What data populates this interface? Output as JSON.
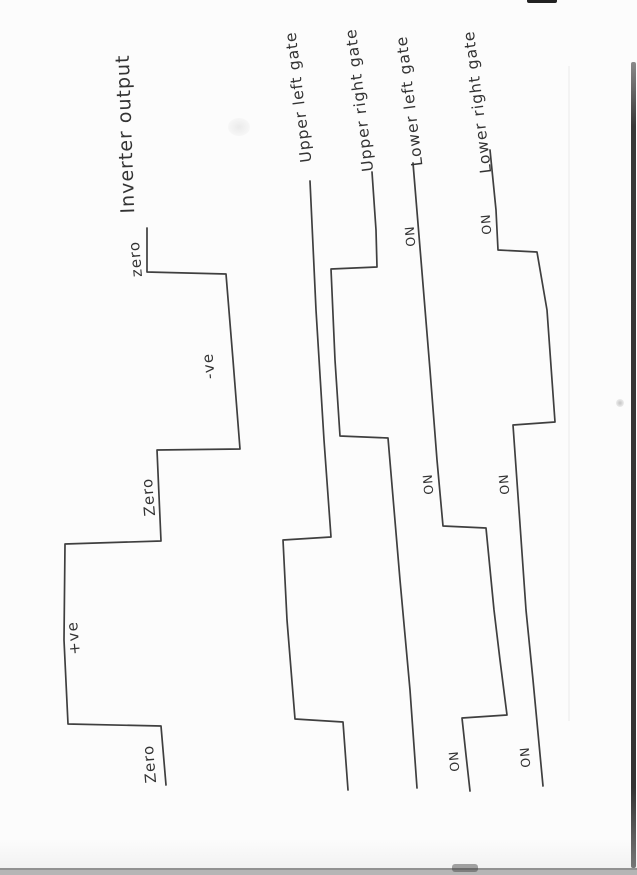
{
  "page": {
    "kind": "scanned hand-drawn waveform diagram, rotated 90° (text reads bottom-to-top)",
    "paper_color": "#fcfcfc",
    "ink_color": "#3f3f3f",
    "edge_strip_color": "#b5b5b5",
    "right_shadow_color": "#3a3a3a"
  },
  "diagram": {
    "signals": [
      {
        "id": "inverter-output",
        "name_label": {
          "text": "Inverter output",
          "x": 126,
          "y": 134,
          "size": 19,
          "angle": -92,
          "title": true
        },
        "points": [
          [
            147,
            228
          ],
          [
            147,
            272
          ],
          [
            226,
            274
          ],
          [
            233,
            360
          ],
          [
            240,
            449
          ],
          [
            157,
            450
          ],
          [
            161,
            541
          ],
          [
            65,
            544
          ],
          [
            64,
            640
          ],
          [
            68,
            724
          ],
          [
            161,
            726
          ],
          [
            166,
            785
          ]
        ],
        "value_labels": [
          {
            "text": "zero",
            "x": 136,
            "y": 259,
            "size": 15,
            "angle": -95
          },
          {
            "text": "-ve",
            "x": 209,
            "y": 366,
            "size": 15,
            "angle": -95
          },
          {
            "text": "Zero",
            "x": 149,
            "y": 497,
            "size": 15,
            "angle": -95
          },
          {
            "text": "+ve",
            "x": 74,
            "y": 638,
            "size": 15,
            "angle": -95
          },
          {
            "text": "Zero",
            "x": 150,
            "y": 764,
            "size": 15,
            "angle": -95
          }
        ]
      },
      {
        "id": "upper-left-gate",
        "name_label": {
          "text": "Upper left gate",
          "x": 299,
          "y": 97,
          "size": 15.5,
          "angle": -97
        },
        "points": [
          [
            310,
            181
          ],
          [
            316,
            310
          ],
          [
            324,
            440
          ],
          [
            331,
            537
          ],
          [
            283,
            540
          ],
          [
            287,
            620
          ],
          [
            295,
            719
          ],
          [
            343,
            722
          ],
          [
            348,
            790
          ]
        ],
        "value_labels": []
      },
      {
        "id": "upper-right-gate",
        "name_label": {
          "text": "Upper right gate",
          "x": 360,
          "y": 100,
          "size": 15.5,
          "angle": -97
        },
        "points": [
          [
            372,
            172
          ],
          [
            376,
            230
          ],
          [
            377,
            267
          ],
          [
            331,
            269
          ],
          [
            335,
            360
          ],
          [
            340,
            436
          ],
          [
            388,
            438
          ],
          [
            400,
            580
          ],
          [
            410,
            690
          ],
          [
            417,
            788
          ]
        ],
        "value_labels": []
      },
      {
        "id": "lower-left-gate",
        "name_label": {
          "text": "Lower left gate",
          "x": 410,
          "y": 101,
          "size": 15.5,
          "angle": -97
        },
        "points": [
          [
            413,
            163
          ],
          [
            421,
            260
          ],
          [
            430,
            370
          ],
          [
            437,
            460
          ],
          [
            443,
            526
          ],
          [
            486,
            528
          ],
          [
            494,
            610
          ],
          [
            500,
            660
          ],
          [
            507,
            715
          ],
          [
            462,
            718
          ],
          [
            466,
            755
          ],
          [
            470,
            791
          ]
        ],
        "value_labels": [
          {
            "text": "ON",
            "x": 411,
            "y": 236,
            "size": 12.5,
            "angle": -95,
            "on": true
          },
          {
            "text": "ON",
            "x": 429,
            "y": 484,
            "size": 12.5,
            "angle": -95,
            "on": true
          },
          {
            "text": "ON",
            "x": 455,
            "y": 761,
            "size": 12.5,
            "angle": -95,
            "on": true
          }
        ]
      },
      {
        "id": "lower-right-gate",
        "name_label": {
          "text": "Lower right gate",
          "x": 478,
          "y": 102,
          "size": 15.5,
          "angle": -97
        },
        "points": [
          [
            490,
            150
          ],
          [
            496,
            210
          ],
          [
            498,
            250
          ],
          [
            537,
            252
          ],
          [
            547,
            310
          ],
          [
            555,
            422
          ],
          [
            513,
            425
          ],
          [
            519,
            510
          ],
          [
            526,
            610
          ],
          [
            533,
            680
          ],
          [
            543,
            786
          ]
        ],
        "value_labels": [
          {
            "text": "ON",
            "x": 487,
            "y": 224,
            "size": 12.5,
            "angle": -95,
            "on": true
          },
          {
            "text": "ON",
            "x": 505,
            "y": 484,
            "size": 12.5,
            "angle": -95,
            "on": true
          },
          {
            "text": "ON",
            "x": 526,
            "y": 757,
            "size": 12.5,
            "angle": -95,
            "on": true
          }
        ]
      }
    ]
  }
}
